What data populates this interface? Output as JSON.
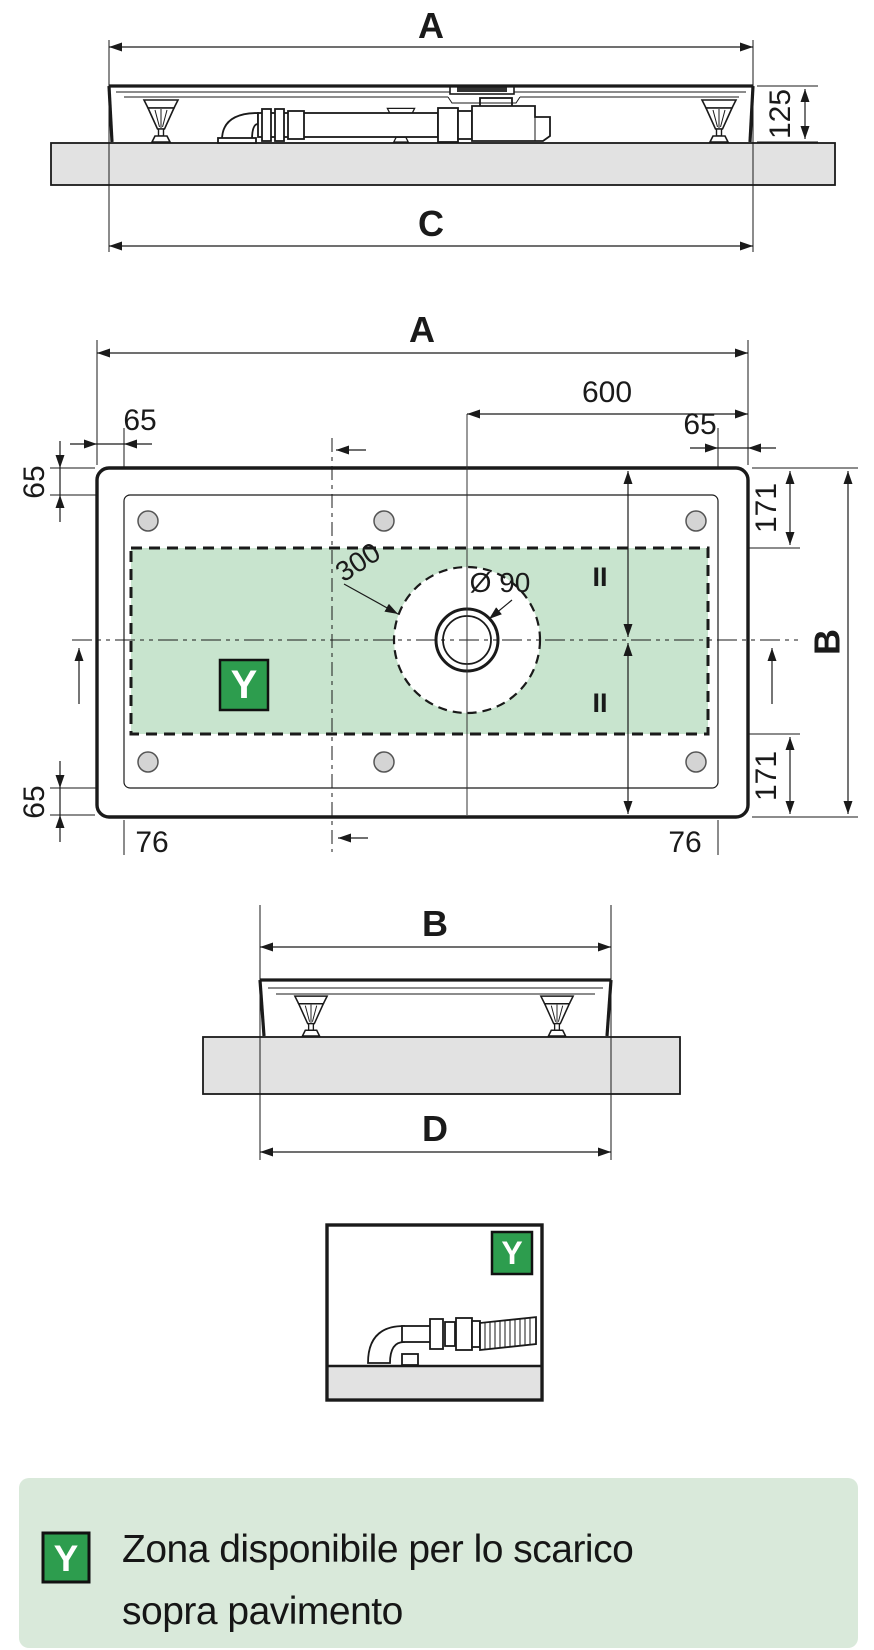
{
  "drawing": {
    "side_view": {
      "width_label": "A",
      "height_label": "125",
      "base_label": "C"
    },
    "plan_view": {
      "width_label": "A",
      "drain_offset": "600",
      "edge_margin": "65",
      "rim_inset": "171",
      "depth_label": "B",
      "corner_offset": "76",
      "zone_radius": "300",
      "drain_diameter": "Ø 90",
      "equal_mark": "II",
      "zone_tag": "Y"
    },
    "end_view": {
      "depth_label": "B",
      "base_label": "D"
    },
    "detail_view": {
      "zone_tag": "Y"
    }
  },
  "legend": {
    "tag": "Y",
    "line1": "Zona disponibile per lo scarico",
    "line2": "sopra pavimento"
  },
  "colors": {
    "zone_green": "#c8e4ce",
    "badge_green": "#2d9d4e",
    "legend_bg": "#d9e9da",
    "floor_gray": "#e2e2e2",
    "line": "#1a1a1a"
  }
}
